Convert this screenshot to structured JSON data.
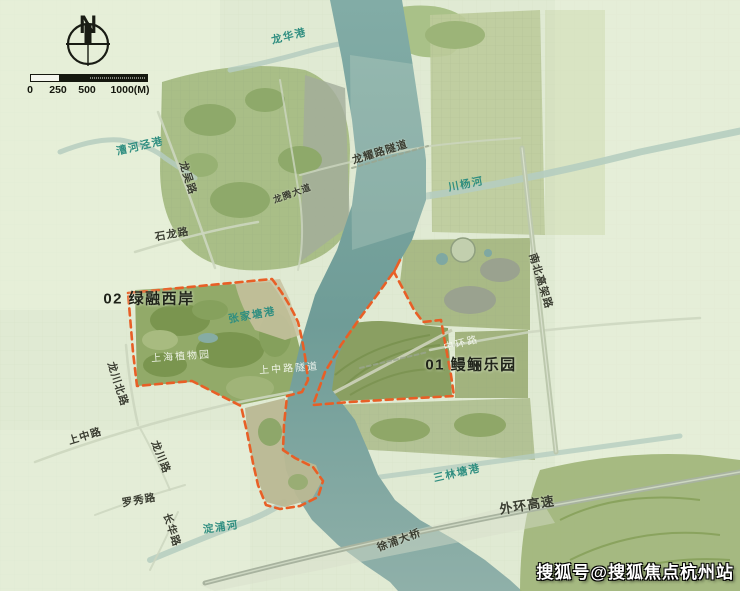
{
  "canvas": {
    "w": 740,
    "h": 591
  },
  "compass": {
    "label": "N"
  },
  "scalebar": {
    "segments": [
      {
        "w": 28,
        "type": "light"
      },
      {
        "w": 29,
        "type": "dark"
      },
      {
        "w": 59,
        "type": "dotted"
      }
    ],
    "ticks": [
      {
        "text": "0",
        "x": 0
      },
      {
        "text": "250",
        "x": 28
      },
      {
        "text": "500",
        "x": 57
      },
      {
        "text": "1000(M)",
        "x": 100
      }
    ]
  },
  "region_labels": [
    {
      "name": "region-label-02-lvrong-west-bank",
      "text": "02 绿融西岸",
      "x": 149,
      "y": 298,
      "rotate": 0
    },
    {
      "name": "region-label-01-manli-park",
      "text": "01 鳗鲡乐园",
      "x": 471,
      "y": 364,
      "rotate": 0
    }
  ],
  "road_labels": [
    {
      "name": "road-label-longwu-lu",
      "text": "龙吴路",
      "x": 188,
      "y": 178,
      "rotate": 72
    },
    {
      "name": "road-label-shilong-lu",
      "text": "石龙路",
      "x": 172,
      "y": 234,
      "rotate": -10
    },
    {
      "name": "road-label-longteng-dadao",
      "text": "龙腾大道",
      "x": 292,
      "y": 193,
      "rotate": -20,
      "size": 9
    },
    {
      "name": "road-label-longyao-lu-tunnel",
      "text": "龙耀路隧道",
      "x": 380,
      "y": 152,
      "rotate": -17
    },
    {
      "name": "road-label-nanbei-elevated-rd",
      "text": "南北高架路",
      "x": 541,
      "y": 281,
      "rotate": 73
    },
    {
      "name": "road-label-longchuan-north-lu",
      "text": "龙川北路",
      "x": 118,
      "y": 384,
      "rotate": 72
    },
    {
      "name": "road-label-shangzhong-lu",
      "text": "上中路",
      "x": 85,
      "y": 436,
      "rotate": -17
    },
    {
      "name": "road-label-longchuan-lu",
      "text": "龙川路",
      "x": 161,
      "y": 457,
      "rotate": 68
    },
    {
      "name": "road-label-luoxiu-lu",
      "text": "罗秀路",
      "x": 139,
      "y": 500,
      "rotate": -10
    },
    {
      "name": "road-label-changhua-lu",
      "text": "长华路",
      "x": 172,
      "y": 530,
      "rotate": 72
    },
    {
      "name": "road-label-waihuan-expressway",
      "text": "外环高速",
      "x": 527,
      "y": 504,
      "rotate": -9,
      "size": 13
    },
    {
      "name": "road-label-xupu-bridge",
      "text": "徐浦大桥",
      "x": 399,
      "y": 540,
      "rotate": -20
    }
  ],
  "water_labels": [
    {
      "name": "water-label-longhua-gang",
      "text": "龙华港",
      "x": 289,
      "y": 36,
      "rotate": -14
    },
    {
      "name": "water-label-caohejing-gang",
      "text": "漕河泾港",
      "x": 140,
      "y": 146,
      "rotate": -13
    },
    {
      "name": "water-label-zhangjiatang-gang",
      "text": "张家塘港",
      "x": 252,
      "y": 315,
      "rotate": -10
    },
    {
      "name": "water-label-chuanyang-he",
      "text": "川杨河",
      "x": 466,
      "y": 184,
      "rotate": -11
    },
    {
      "name": "water-label-sanlintang-gang",
      "text": "三林塘港",
      "x": 457,
      "y": 473,
      "rotate": -13
    },
    {
      "name": "water-label-dianpu-he",
      "text": "淀浦河",
      "x": 221,
      "y": 527,
      "rotate": -8
    }
  ],
  "place_labels": [
    {
      "name": "place-label-shanghai-botanical-garden",
      "text": "上海植物园",
      "x": 181,
      "y": 355,
      "rotate": -4
    },
    {
      "name": "place-label-shangzhong-lu-tunnel",
      "text": "上中路隧道",
      "x": 289,
      "y": 367,
      "rotate": -4
    },
    {
      "name": "place-label-zhonghuan-lu",
      "text": "中环路",
      "x": 461,
      "y": 342,
      "rotate": -14
    }
  ],
  "watermark": {
    "text": "搜狐号@搜狐焦点杭州站"
  },
  "colors": {
    "boundary": "#E85F26",
    "river": "#7AA5A0",
    "canal": "#B5CDC0",
    "base": "#E0EAD3",
    "water_label": "#2F8E80"
  }
}
